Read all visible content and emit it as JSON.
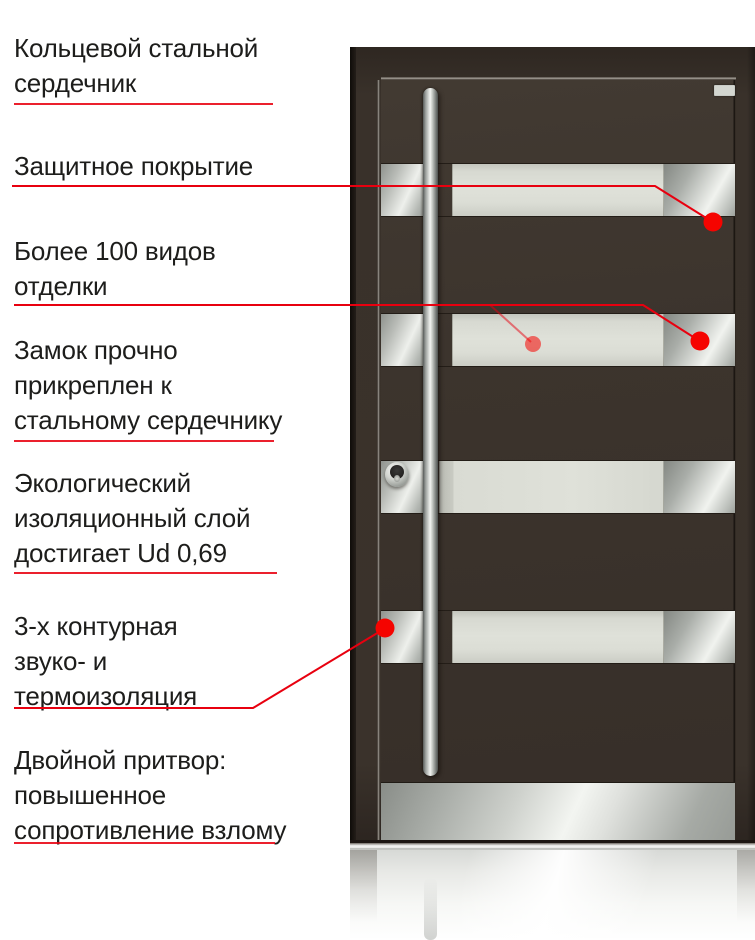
{
  "page": {
    "language": "ru",
    "kind": "entrance-door features infographic"
  },
  "colors": {
    "accent_red": "#e8000f",
    "dot_red": "#f50400",
    "door_brown": "#3a322c",
    "door_frame_brown": "#362e27",
    "glass_panel": "#dcded6",
    "steel_light": "#eff1ed",
    "steel_mid": "#b5b9b4",
    "text": "#1d1d1b",
    "background": "#ffffff"
  },
  "door": {
    "glass_stripe_count": 4
  },
  "annotations": [
    {
      "id": "ring-steel-core",
      "text": "Кольцевой стальной сердечник",
      "lines": [
        "Кольцевой стальной",
        "сердечник"
      ]
    },
    {
      "id": "protective-coating",
      "text": "Защитное покрытие",
      "lines": [
        "Защитное покрытие"
      ]
    },
    {
      "id": "finishes",
      "text": "Более 100 видов отделки",
      "lines": [
        "Более 100 видов",
        "отделки"
      ]
    },
    {
      "id": "lock-attached",
      "text": "Замок прочно прикреплен к стальному сердечнику",
      "lines": [
        "Замок прочно",
        "прикреплен к",
        "стальному сердечнику"
      ]
    },
    {
      "id": "eco-insulation",
      "text": "Экологический изоляционный слой достигает Ud 0,69",
      "lines": [
        "Экологический",
        "изоляционный слой",
        "достигает Ud 0,69"
      ]
    },
    {
      "id": "three-contour-insulation",
      "text": "3-х контурная звуко- и термоизоляция",
      "lines": [
        "3-х контурная",
        "звуко- и",
        "термоизоляция"
      ]
    },
    {
      "id": "double-rebate",
      "text": "Двойной притвор: повышенное сопротивление взлому",
      "lines": [
        "Двойной притвор:",
        "повышенное",
        "сопротивление взлому"
      ]
    }
  ]
}
